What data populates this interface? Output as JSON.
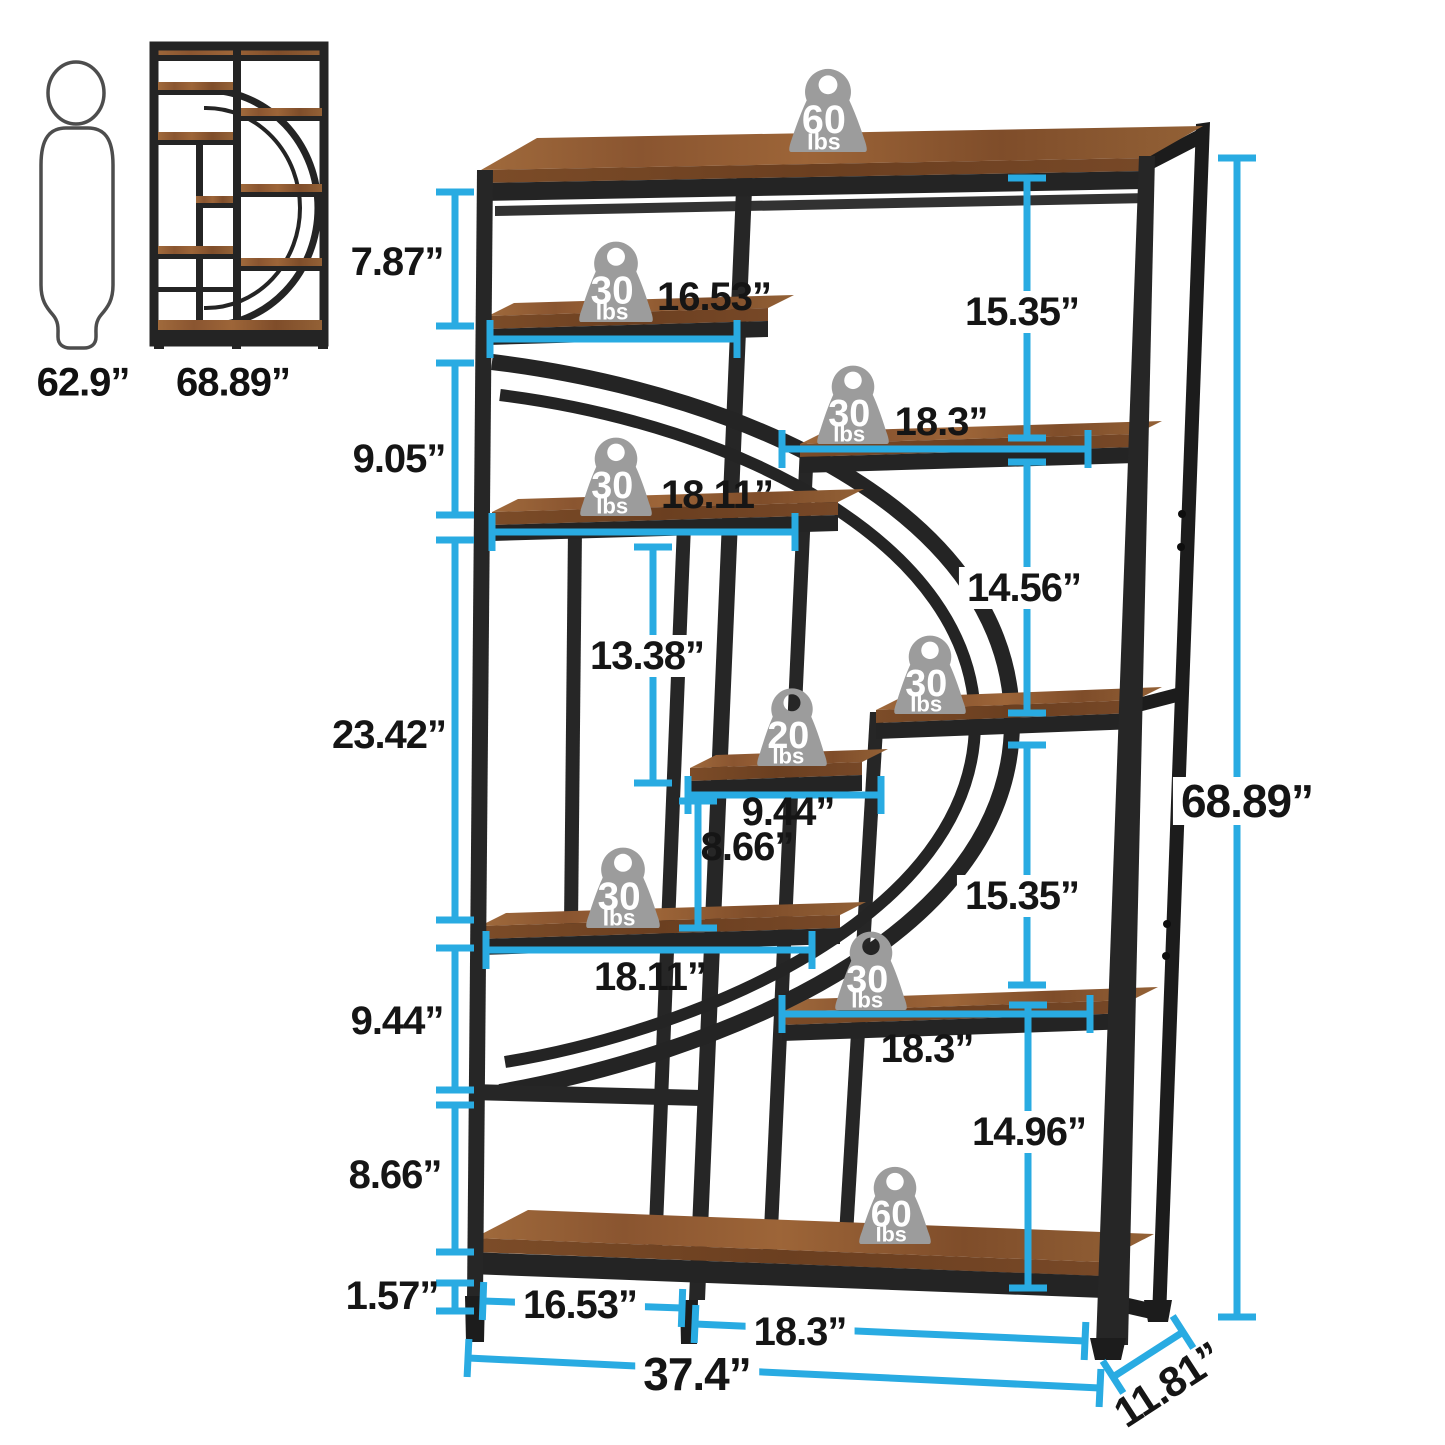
{
  "palette": {
    "dimension_line": "#29abe2",
    "dimension_text": "#151515",
    "frame_dark": "#262626",
    "frame_darker": "#1c1c1c",
    "wood_top": "#9a6134",
    "wood_front": "#6e4223",
    "badge_gray": "#9c9c9c",
    "badge_text": "#ffffff",
    "figure_outline": "#4d4d4d"
  },
  "reference_figures": {
    "person_height_label": "62.9”",
    "mini_shelf_height_label": "68.89”"
  },
  "weight_badges": [
    {
      "value": "60",
      "unit": "Ibs",
      "cx": 828,
      "bottom": 152,
      "w": 82,
      "h": 86
    },
    {
      "value": "30",
      "unit": "Ibs",
      "cx": 616,
      "bottom": 322,
      "w": 78,
      "h": 84
    },
    {
      "value": "30",
      "unit": "Ibs",
      "cx": 853,
      "bottom": 444,
      "w": 76,
      "h": 82
    },
    {
      "value": "30",
      "unit": "Ibs",
      "cx": 616,
      "bottom": 516,
      "w": 76,
      "h": 82
    },
    {
      "value": "30",
      "unit": "Ibs",
      "cx": 930,
      "bottom": 714,
      "w": 76,
      "h": 82
    },
    {
      "value": "20",
      "unit": "Ibs",
      "cx": 792,
      "bottom": 766,
      "w": 74,
      "h": 82
    },
    {
      "value": "30",
      "unit": "Ibs",
      "cx": 623,
      "bottom": 928,
      "w": 78,
      "h": 84
    },
    {
      "value": "30",
      "unit": "Ibs",
      "cx": 871,
      "bottom": 1010,
      "w": 76,
      "h": 82
    },
    {
      "value": "60",
      "unit": "Ibs",
      "cx": 895,
      "bottom": 1244,
      "w": 76,
      "h": 80
    }
  ],
  "dimensions": [
    {
      "label": "7.87”",
      "type": "v",
      "x": 455,
      "y1": 192,
      "y2": 326,
      "lx": 397,
      "ly": 262,
      "placement": "side"
    },
    {
      "label": "9.05”",
      "type": "v",
      "x": 455,
      "y1": 363,
      "y2": 515,
      "lx": 399,
      "ly": 459,
      "placement": "side"
    },
    {
      "label": "23.42”",
      "type": "v",
      "x": 455,
      "y1": 540,
      "y2": 920,
      "lx": 389,
      "ly": 735,
      "placement": "side"
    },
    {
      "label": "9.44”",
      "type": "v",
      "x": 455,
      "y1": 948,
      "y2": 1090,
      "lx": 397,
      "ly": 1021,
      "placement": "side"
    },
    {
      "label": "8.66”",
      "type": "v",
      "x": 455,
      "y1": 1105,
      "y2": 1252,
      "lx": 395,
      "ly": 1175,
      "placement": "side"
    },
    {
      "label": "1.57”",
      "type": "v",
      "x": 455,
      "y1": 1283,
      "y2": 1311,
      "lx": 392,
      "ly": 1296,
      "placement": "side"
    },
    {
      "label": "16.53”",
      "type": "h",
      "y": 339,
      "x1": 490,
      "x2": 737,
      "lx": 714,
      "ly": 297,
      "placement": "side"
    },
    {
      "label": "18.3”",
      "type": "h",
      "y": 449,
      "x1": 782,
      "x2": 1088,
      "lx": 941,
      "ly": 422,
      "placement": "side"
    },
    {
      "label": "18.11”",
      "type": "h",
      "y": 532,
      "x1": 492,
      "x2": 795,
      "lx": 717,
      "ly": 495,
      "placement": "side"
    },
    {
      "label": "13.38”",
      "type": "v",
      "x": 653,
      "y1": 547,
      "y2": 783,
      "lx": 647,
      "ly": 656,
      "placement": "on"
    },
    {
      "label": "9.44”",
      "type": "h",
      "y": 795,
      "x1": 688,
      "x2": 881,
      "lx": 788,
      "ly": 812,
      "placement": "side"
    },
    {
      "label": "8.66”",
      "type": "v",
      "x": 698,
      "y1": 801,
      "y2": 928,
      "lx": 747,
      "ly": 847,
      "placement": "side"
    },
    {
      "label": "18.11”",
      "type": "h",
      "y": 950,
      "x1": 486,
      "x2": 812,
      "lx": 650,
      "ly": 977,
      "placement": "side"
    },
    {
      "label": "15.35”",
      "type": "v",
      "x": 1027,
      "y1": 178,
      "y2": 438,
      "lx": 1022,
      "ly": 312,
      "placement": "on"
    },
    {
      "label": "14.56”",
      "type": "v",
      "x": 1027,
      "y1": 462,
      "y2": 713,
      "lx": 1024,
      "ly": 588,
      "placement": "on"
    },
    {
      "label": "15.35”",
      "type": "v",
      "x": 1027,
      "y1": 745,
      "y2": 985,
      "lx": 1022,
      "ly": 896,
      "placement": "on"
    },
    {
      "label": "14.96”",
      "type": "v",
      "x": 1028,
      "y1": 1005,
      "y2": 1288,
      "lx": 1029,
      "ly": 1132,
      "placement": "on"
    },
    {
      "label": "18.3”",
      "type": "h",
      "y": 1014,
      "x1": 782,
      "x2": 1090,
      "lx": 927,
      "ly": 1049,
      "placement": "side"
    },
    {
      "label": "16.53”",
      "type": "d",
      "x1": 483,
      "y1": 1301,
      "x2": 682,
      "y2": 1308,
      "lx": 580,
      "ly": 1305,
      "placement": "on"
    },
    {
      "label": "18.3”",
      "type": "d",
      "x1": 695,
      "y1": 1324,
      "x2": 1085,
      "y2": 1341,
      "lx": 800,
      "ly": 1332,
      "placement": "on"
    },
    {
      "label": "37.4”",
      "type": "d",
      "x1": 468,
      "y1": 1358,
      "x2": 1100,
      "y2": 1388,
      "lx": 697,
      "ly": 1374,
      "placement": "on",
      "fs": 46
    },
    {
      "label": "68.89”",
      "type": "v",
      "x": 1237,
      "y1": 158,
      "y2": 1317,
      "lx": 1247,
      "ly": 801,
      "placement": "on",
      "fs": 46
    },
    {
      "label": "11.81”",
      "type": "d",
      "x1": 1113,
      "y1": 1377,
      "x2": 1183,
      "y2": 1332,
      "lx": 1168,
      "ly": 1385,
      "placement": "side",
      "rot": -33,
      "fs": 42
    }
  ]
}
